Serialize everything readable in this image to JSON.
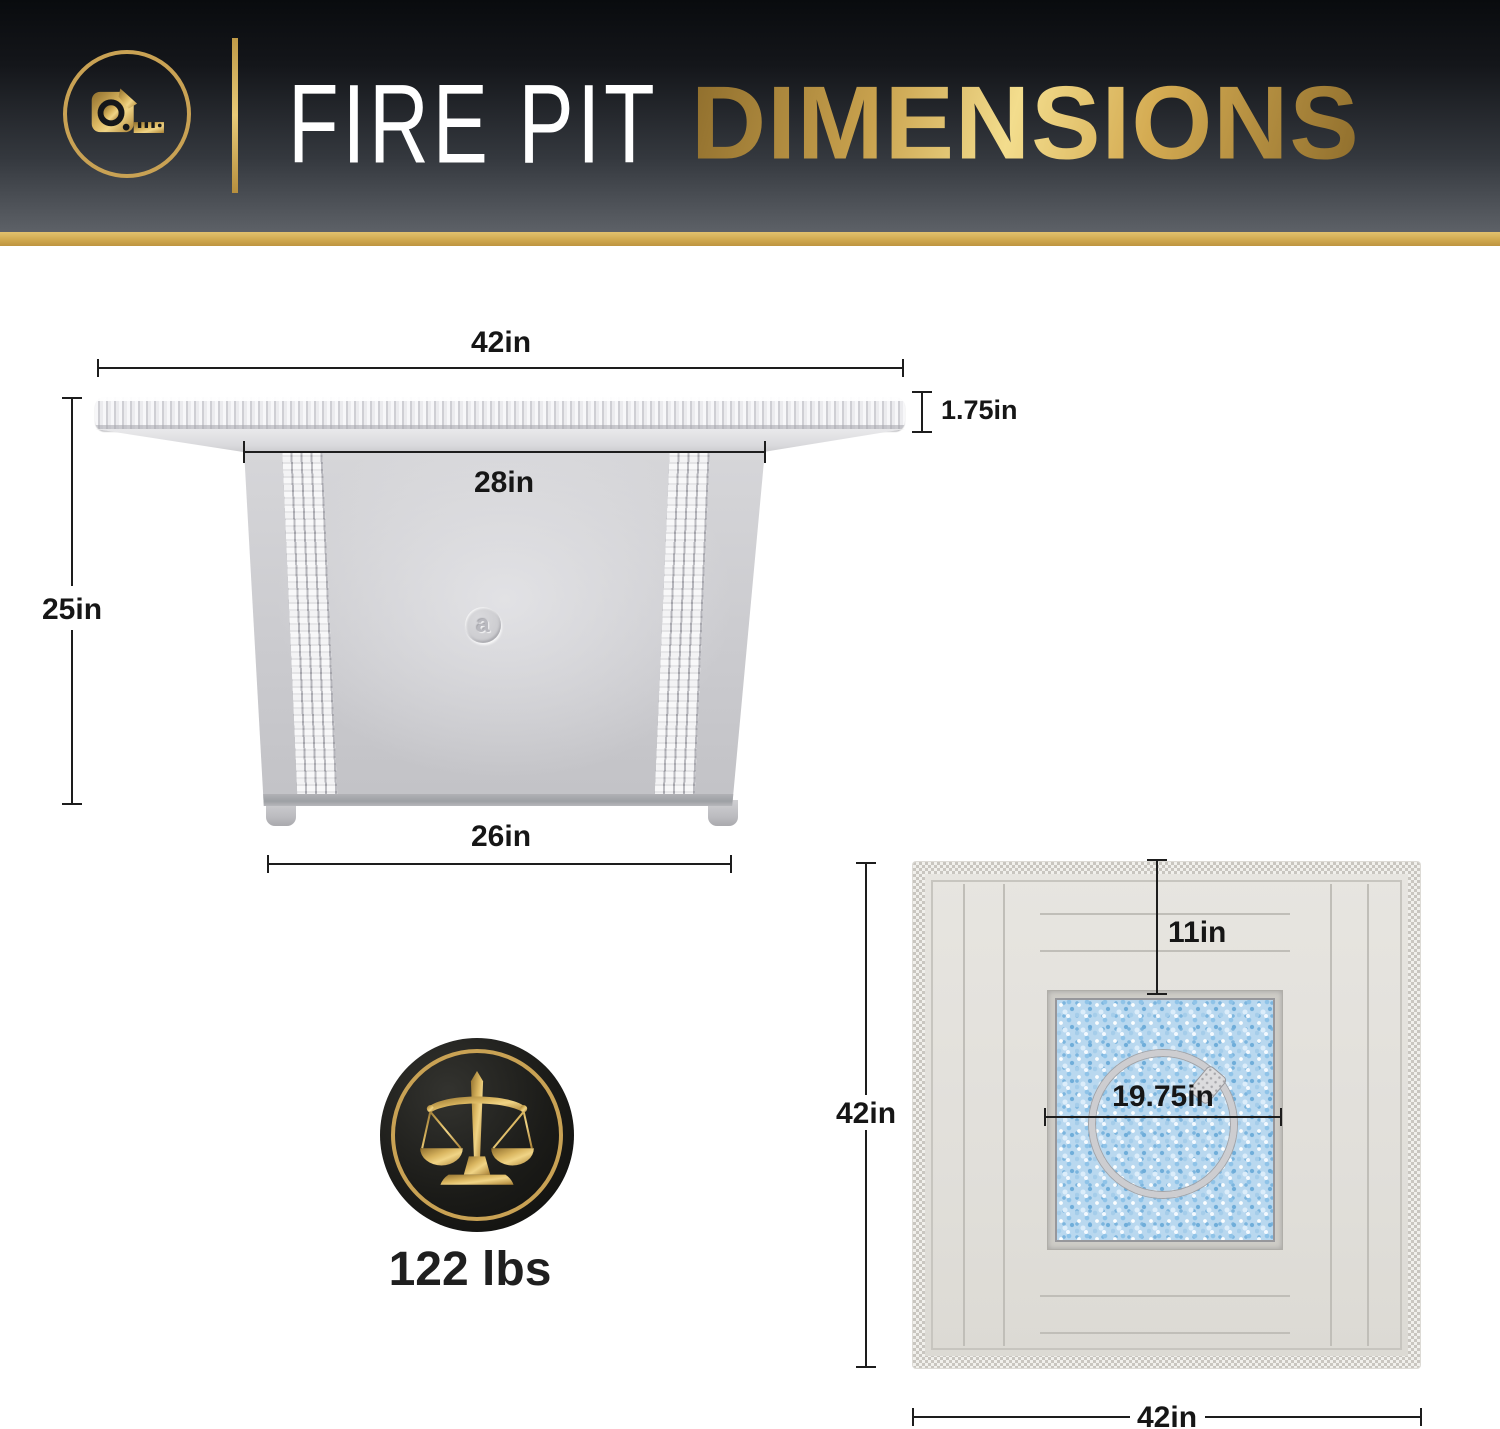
{
  "header": {
    "icon": "tape-measure-icon",
    "title_regular": "FIRE PIT",
    "title_bold": "DIMENSIONS"
  },
  "side_view": {
    "description": "fire pit table side elevation",
    "dimensions": {
      "top_width": "42in",
      "top_thickness": "1.75in",
      "frame_top_width": "28in",
      "height": "25in",
      "base_width": "26in"
    },
    "logo_letter": "a"
  },
  "weight": {
    "icon": "balance-scale-icon",
    "value": "122 lbs"
  },
  "top_view": {
    "description": "fire pit table top view with fire glass and burner ring",
    "dimensions": {
      "side_length": "42in",
      "bottom_width": "42in",
      "glass_inset": "11in",
      "burner_width": "19.75in"
    }
  },
  "colors": {
    "gold": "#c9a254",
    "header_top": "#0a0c0f",
    "header_bottom": "#5d6167",
    "dimension_line": "#1d1d1d",
    "fire_glass": "#b9d8ef"
  }
}
